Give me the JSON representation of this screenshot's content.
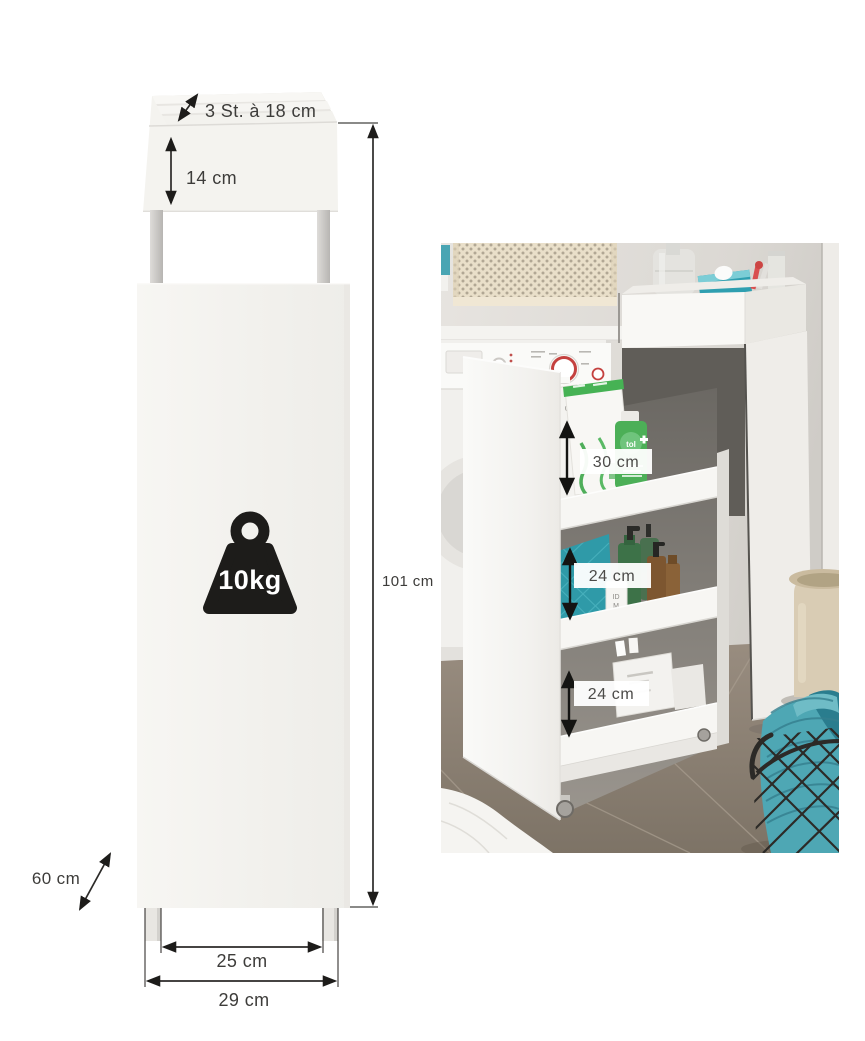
{
  "diagram": {
    "labels": {
      "slot_pitch": "3 St. à 18 cm",
      "top_box_height": "14 cm",
      "total_height": "101 cm",
      "depth": "60 cm",
      "inner_width": "25 cm",
      "outer_width": "29 cm",
      "max_load": "10kg"
    },
    "icons": {
      "max_load": "weight-icon"
    },
    "colors": {
      "panel": "#f3f2ee",
      "panel_shadow": "#e3e1dd",
      "leg_gray": "#c9c7c4",
      "line": "#2b2a28",
      "text": "#3d3c3a",
      "icon_black": "#1d1c1a"
    }
  },
  "photo": {
    "shelf_labels": {
      "top_shelf": "30 cm",
      "middle_shelf": "24 cm",
      "bottom_shelf": "24 cm"
    },
    "packaging_text": {
      "carton_fragment_1": "Hom",
      "carton_fragment_2": "de",
      "green_bottle_fragment": "tol",
      "soap_bottle_fragment_1": "ID",
      "soap_bottle_fragment_2": "M"
    },
    "colors": {
      "wall": "#e2dfdb",
      "floor": "#8b8073",
      "white_furniture": "#f5f4f1",
      "wicker": "#e9dfc9",
      "teal": "#35a0af",
      "teal_dark": "#2a7d8e",
      "green": "#46b254",
      "bottle_green": "#3c7147",
      "amber": "#7d5630",
      "bucket": "#d9ccb4",
      "wire": "#2c2a27",
      "dial_red": "#c4413f",
      "label_text": "#4c4b49"
    }
  }
}
